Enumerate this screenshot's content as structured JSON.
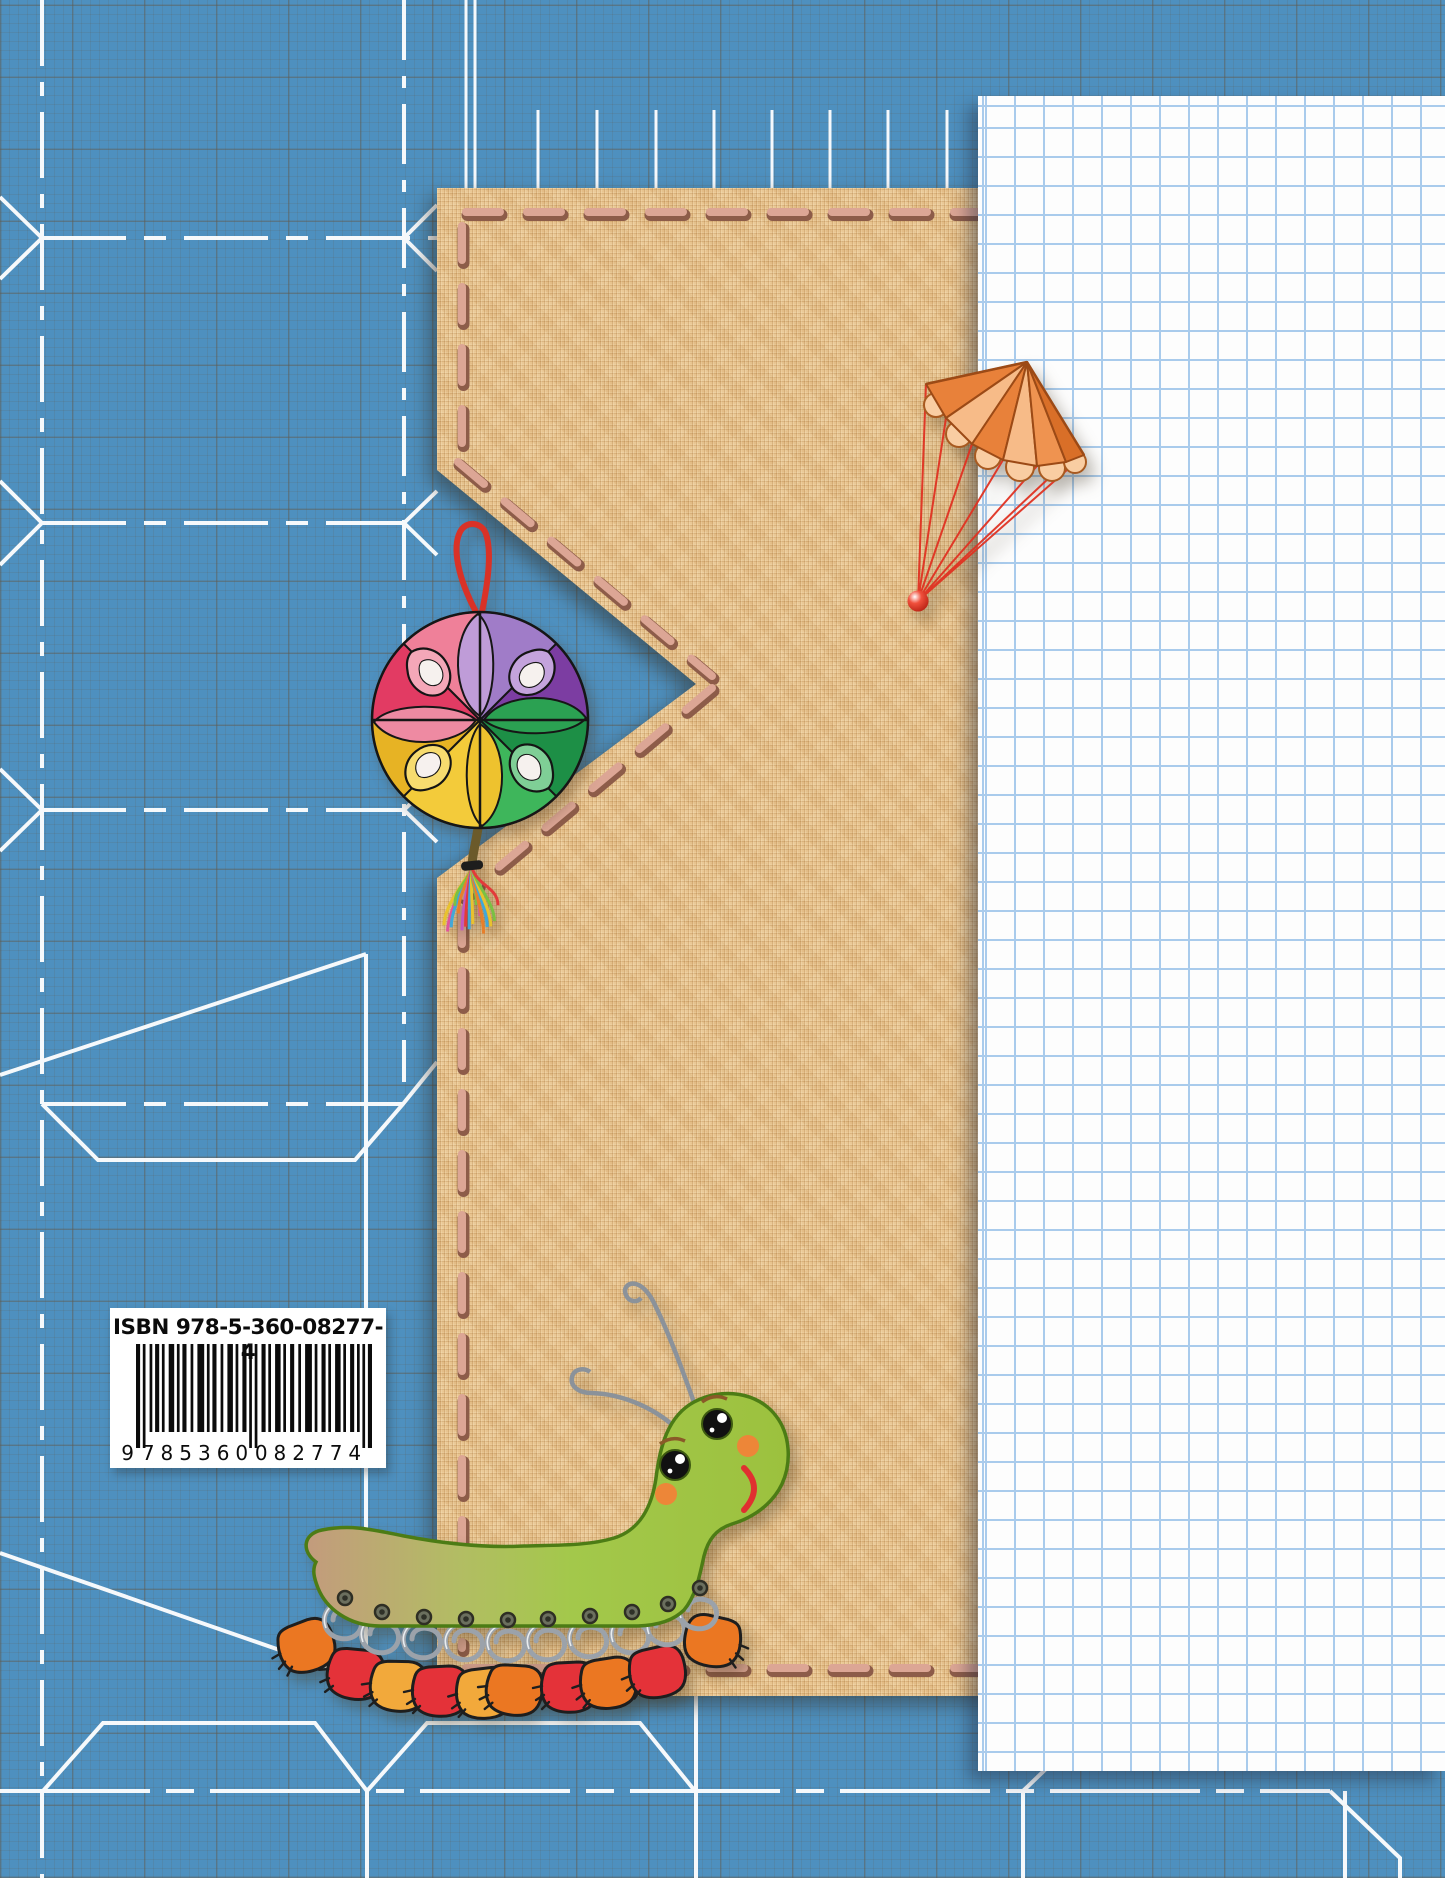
{
  "isbn": {
    "label": "ISBN 978-5-360-08277-4",
    "ean_digits": "9 785360 082774",
    "g1": "9",
    "g2": "785360",
    "g3": "082774"
  },
  "illustrations": {
    "parachute-illustration": "orange paper parachute with red shroud lines and red bead",
    "ornament-illustration": "four-color paper ball ornament with red hanging loop and rainbow tassel",
    "caterpillar-illustration": "green paper caterpillar with wire antennae, wire-ring legs and colored paper shoes",
    "burlap-panel": "stitched burlap fabric panel with notched edge",
    "graph-paper-panel": "sheet of squared graph paper",
    "blueprint-pattern": "white box-unfolding blueprint line drawings on blue millimeter grid"
  },
  "colors": {
    "background_blue": "#4E90BF",
    "grid_line_gray": "#5F5C52",
    "burlap_tan": "#E8C48F",
    "stitch_pink": "#DCA695",
    "stitch_outline": "#8D5C49",
    "graph_line_blue": "#A9CBEC",
    "blueprint_white": "#FFFFFF",
    "parachute_dark": "#E8813A",
    "parachute_light": "#F7BB88",
    "parachute_fringe": "#F9CDA2",
    "string_red": "#E03222",
    "ornament_pink_light": "#EF8099",
    "ornament_pink_dark": "#E23B63",
    "ornament_purple_light": "#A07CC8",
    "ornament_purple_dark": "#7C3DA2",
    "ornament_green_light": "#3EB65B",
    "ornament_green_dark": "#1D8F46",
    "ornament_yellow_light": "#F3CB3A",
    "ornament_yellow_dark": "#E7B324",
    "caterpillar_green": "#9CC13E",
    "caterpillar_edge": "#4C7C15",
    "caterpillar_tail_tan": "#C39B7D",
    "cheek_orange": "#ED8638",
    "smile_red": "#E03030",
    "wire_gray": "#9BA2AA",
    "red": "#E43239",
    "orange": "#EB7722",
    "yellow": "#F2A93B"
  }
}
